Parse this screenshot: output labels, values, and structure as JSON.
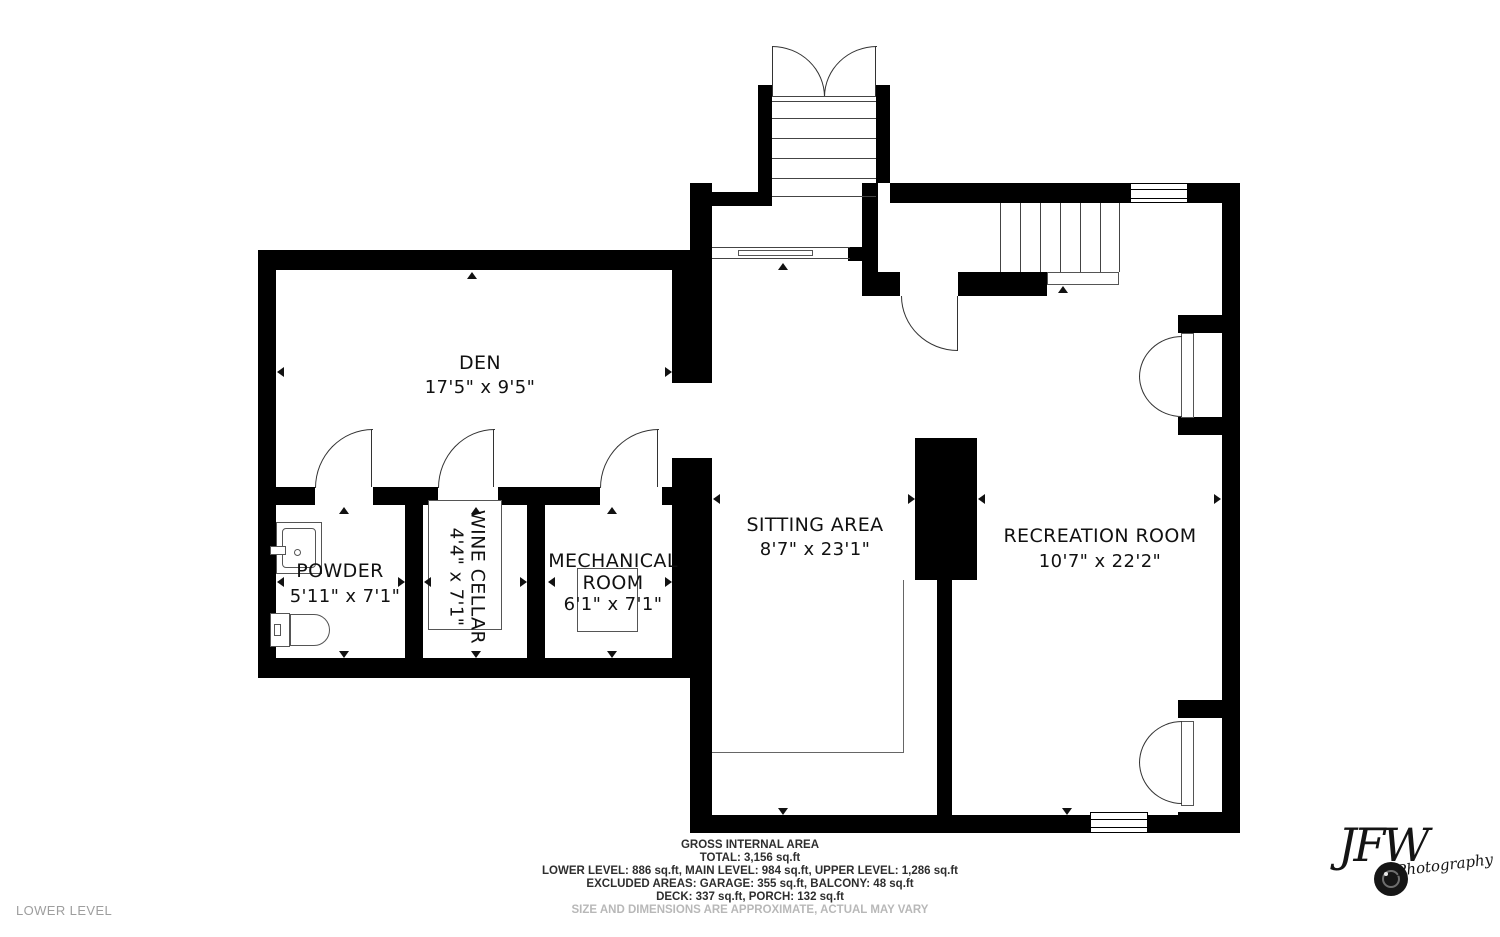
{
  "rooms": {
    "den": {
      "name": "DEN",
      "dims": "17'5\" x 9'5\""
    },
    "powder": {
      "name": "POWDER",
      "dims": "5'11\" x 7'1\""
    },
    "wine_cellar": {
      "name": "WINE CELLAR",
      "dims": "4'4\" x 7'1\""
    },
    "mechanical": {
      "name": "MECHANICAL ROOM",
      "dims": "6'1\" x 7'1\""
    },
    "sitting": {
      "name": "SITTING AREA",
      "dims": "8'7\" x 23'1\""
    },
    "recreation": {
      "name": "RECREATION ROOM",
      "dims": "10'7\" x 22'2\""
    }
  },
  "footer": {
    "area_title": "GROSS INTERNAL AREA",
    "total": "TOTAL: 3,156 sq.ft",
    "levels": "LOWER LEVEL: 886 sq.ft, MAIN LEVEL: 984 sq.ft, UPPER LEVEL: 1,286 sq.ft",
    "excluded": "EXCLUDED AREAS: GARAGE: 355 sq.ft, BALCONY: 48 sq.ft",
    "deck_porch": "DECK: 337 sq.ft, PORCH: 132 sq.ft",
    "disclaimer": "SIZE AND DIMENSIONS ARE APPROXIMATE, ACTUAL MAY VARY"
  },
  "floor_label": "LOWER LEVEL",
  "watermark": {
    "initials": "JFW",
    "sub": "Photography"
  },
  "colors": {
    "wall": "#000000",
    "line": "#444444",
    "muted": "#9e9e9e"
  }
}
